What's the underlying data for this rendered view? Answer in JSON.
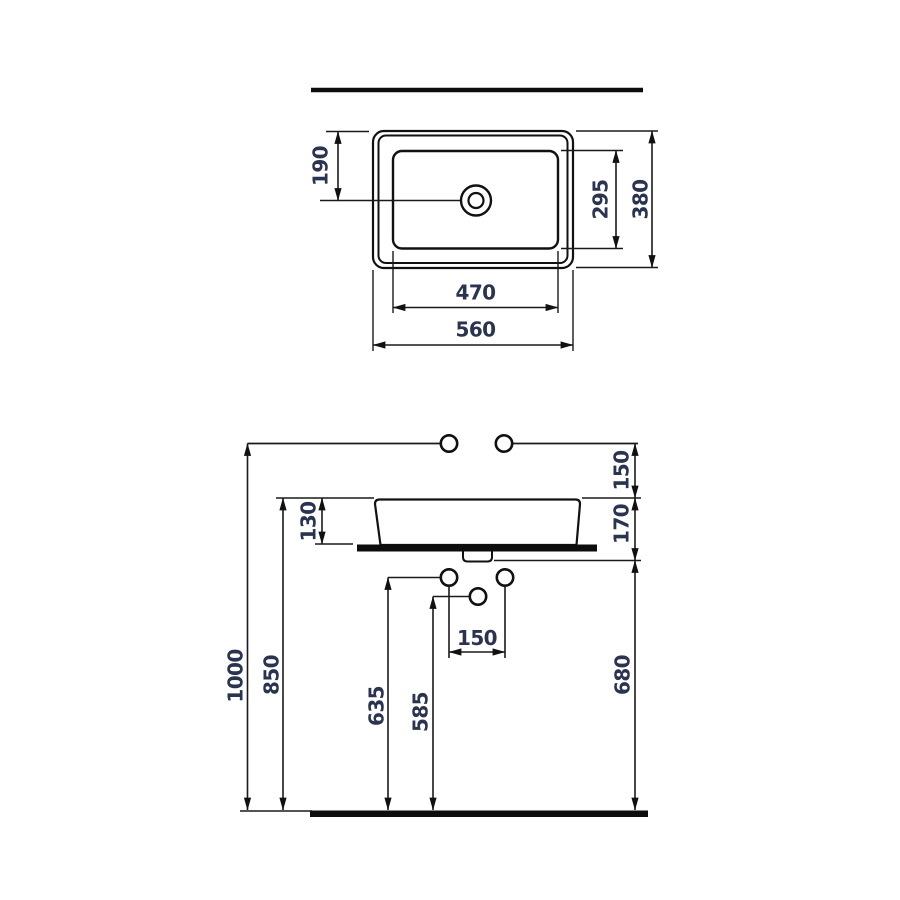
{
  "canvas": {
    "background": "#ffffff",
    "line_color": "#111111",
    "solid_fill": "#0d0d0d",
    "label_color": "#2a3350"
  },
  "top_view": {
    "labels": {
      "drain_offset": "190",
      "basin_depth": "295",
      "overall_depth": "380",
      "basin_width": "470",
      "overall_width": "560"
    }
  },
  "front_view": {
    "labels": {
      "faucet_line_to_rim": "150",
      "rim_to_counter_underside": "170",
      "vessel_height": "130",
      "faucet_line_height": "1000",
      "rim_height": "850",
      "counter_underside_height": "680",
      "supply_hole_height": "635",
      "drain_hole_height": "585",
      "supply_hole_spacing": "150"
    }
  }
}
